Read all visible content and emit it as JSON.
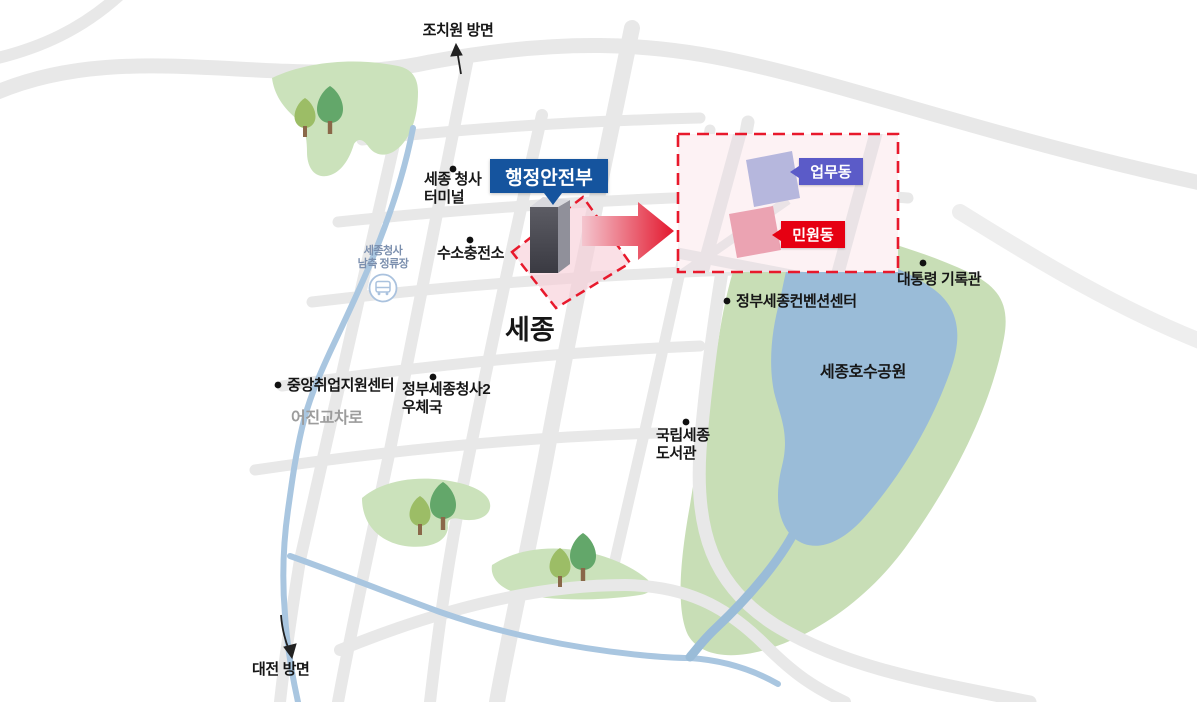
{
  "map": {
    "region_label": "세종",
    "directions": {
      "north": "조치원 방면",
      "south": "대전 방면"
    },
    "callouts": {
      "ministry": {
        "label": "행정안전부",
        "bg": "#15549e"
      },
      "office": {
        "label": "업무동",
        "bg": "#5b5bc8"
      },
      "civil": {
        "label": "민원동",
        "bg": "#e60012"
      }
    },
    "pois": {
      "terminal": {
        "line1": "세종 청사",
        "line2": "터미널"
      },
      "hydrogen": {
        "name": "수소충전소"
      },
      "convention": {
        "name": "정부세종컨벤션센터"
      },
      "archives": {
        "name": "대통령 기록관"
      },
      "lake_park": {
        "name": "세종호수공원"
      },
      "employment": {
        "name": "중앙취업지원센터"
      },
      "post_office": {
        "line1": "정부세종청사2",
        "line2": "우체국"
      },
      "library": {
        "line1": "국립세종",
        "line2": "도서관"
      }
    },
    "bus_stop": {
      "line1": "세종청사",
      "line2": "남측 정류장"
    },
    "road_label": "어진교차로",
    "colors": {
      "road": "#e8e8e8",
      "park_green": "#cbe2bb",
      "lake_park_green": "#c8deb6",
      "lake_blue": "#9abcd8",
      "river_blue": "#a9c6e0",
      "highlight_red": "#e8192c",
      "highlight_pink_fill": "#f7cdd6",
      "inset_bg": "#fdf2f4",
      "ministry_blue": "#15549e",
      "office_purple": "#5b5bc8",
      "office_building": "#b6b7dd",
      "civil_red": "#e60012",
      "civil_building": "#eba3b2",
      "tower_front": "#46464e",
      "tower_side": "#90909a"
    }
  }
}
